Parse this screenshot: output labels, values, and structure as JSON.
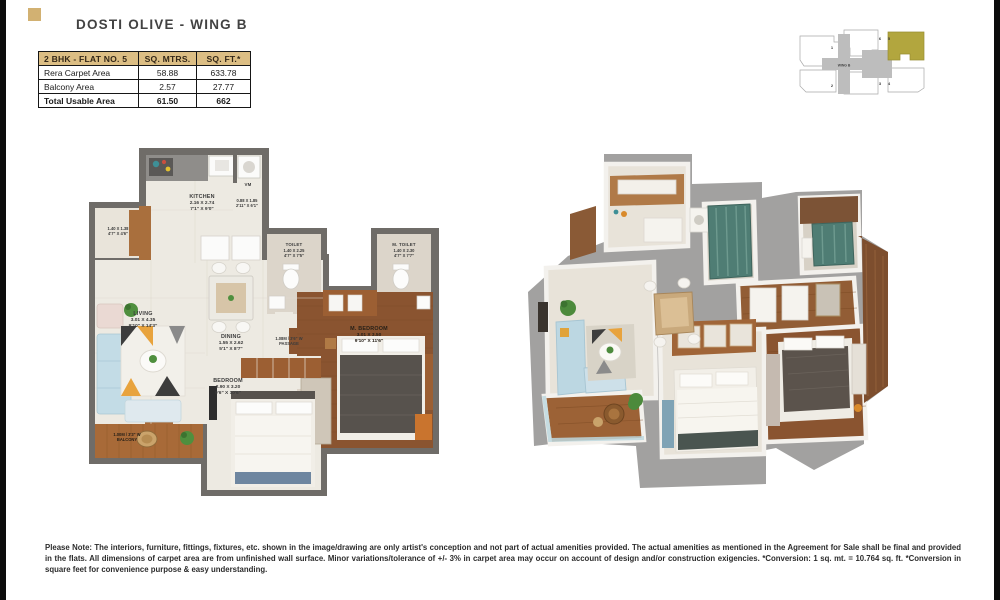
{
  "page": {
    "title": "DOSTI OLIVE - WING B"
  },
  "area_table": {
    "col_flat": "2 BHK - FLAT NO. 5",
    "col_mtrs": "SQ. MTRS.",
    "col_ft": "SQ. FT.*",
    "rows": [
      {
        "label": "Rera Carpet Area",
        "mtrs": "58.88",
        "ft": "633.78"
      },
      {
        "label": "Balcony Area",
        "mtrs": "2.57",
        "ft": "27.77"
      },
      {
        "label": "Total Usable Area",
        "mtrs": "61.50",
        "ft": "662"
      }
    ]
  },
  "key_plan": {
    "wing_label": "WING B",
    "flat_labels": [
      "1",
      "2",
      "3",
      "4",
      "5",
      "6"
    ],
    "highlight_color": "#b2a63e"
  },
  "plan2d": {
    "kitchen": {
      "name": "KITCHEN",
      "m": "2.16 X 2.74",
      "ft": "7'1\" X 9'0\""
    },
    "utility": {
      "name": "VM",
      "m": "0.88 X 1.85",
      "ft": "2'11\" X 6'1\""
    },
    "deck": {
      "m": "1.40 X 1.38",
      "ft": "4'7\" X 4'6\""
    },
    "toilet": {
      "name": "TOILET",
      "m": "1.40 X 2.25",
      "ft": "4'7\" X 7'5\""
    },
    "m_toilet": {
      "name": "M. TOILET",
      "m": "1.40 X 2.30",
      "ft": "4'7\" X 7'7\""
    },
    "living": {
      "name": "LIVING",
      "m": "3.01 X 4.35",
      "ft": "9'10\" X 14'3\""
    },
    "dining": {
      "name": "DINING",
      "m": "1.55 X 2.62",
      "ft": "5'1\" X 8'7\""
    },
    "passage": {
      "line1": "1.08M / 3'6\" W",
      "line2": "PASSAGE"
    },
    "bedroom": {
      "name": "BEDROOM",
      "m": "2.90 X 3.20",
      "ft": "9'6\" X 10'6\""
    },
    "m_bedroom": {
      "name": "M. BEDROOM",
      "m": "3.01 X 3.50",
      "ft": "9'10\" X 11'6\""
    },
    "balcony": {
      "line1": "1.00M / 3'3\" W",
      "line2": "BALCONY"
    }
  },
  "disclaimer": "Please Note: The interiors, furniture, fittings, fixtures, etc. shown in the image/drawing are only artist's conception and not part of actual amenities provided. The actual amenities as mentioned in the Agreement for Sale shall be final and provided in the flats. All dimensions of carpet area are from unfinished wall surface. Minor variations/tolerance of +/- 3% in carpet area may occur on account of design and/or construction exigencies. *Conversion: 1 sq. mt. = 10.764 sq. ft. *Conversion in square feet for convenience purpose & easy understanding."
}
